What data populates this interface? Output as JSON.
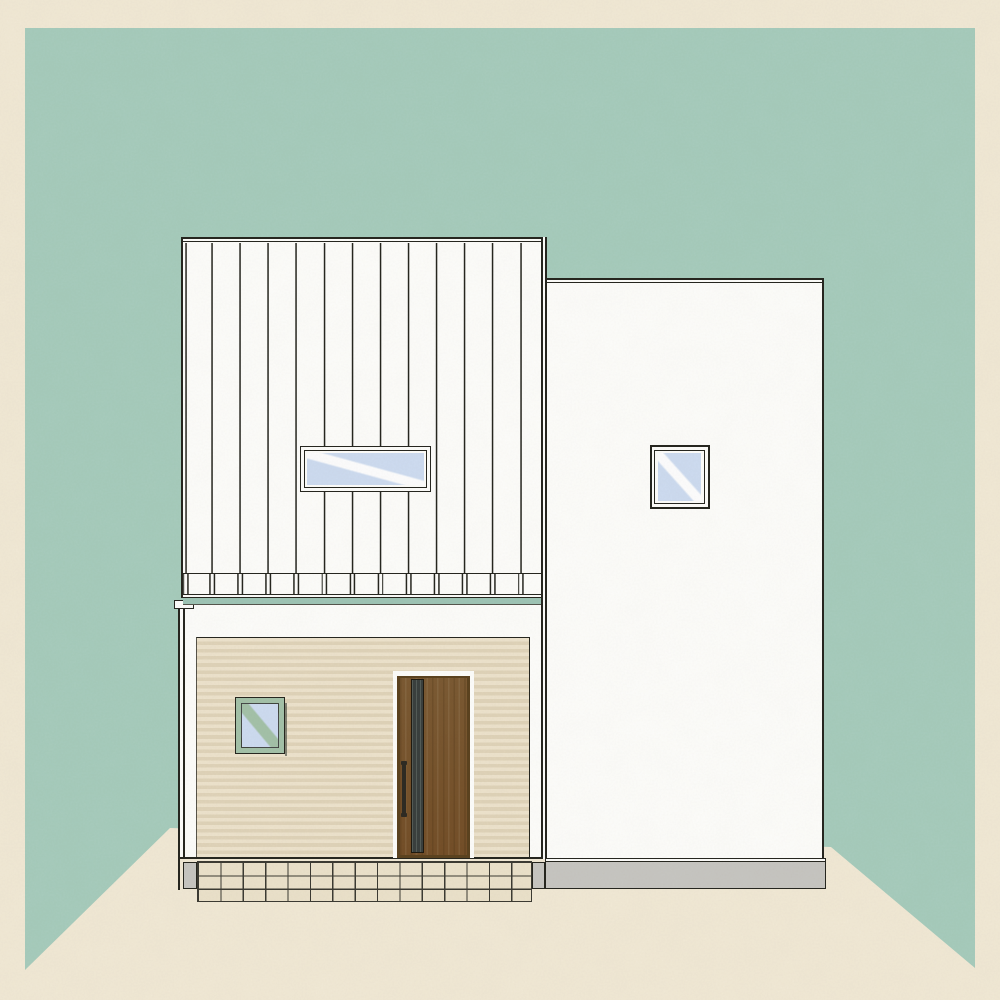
{
  "scene": {
    "type": "architectural-elevation-illustration",
    "subject": "front elevation of a two-story flat-roof house on a teal backdrop with cream paper border",
    "text_content": "none",
    "background": {
      "wall": "teal backdrop wall with 45-degree floor corner diagonals",
      "floor": "cream paper floor",
      "border": "cream paper frame"
    },
    "parts": {
      "upper_left_volume": {
        "cladding": "white vertical board siding with board-end fringe at bottom",
        "window": "wide horizontal window, dark frame, light blue glass with white diagonal reflection"
      },
      "right_volume": {
        "cladding": "plain white wall, dark outline, double parapet line",
        "window": "small square window with double dark frame rings and diagonal reflection",
        "foundation": "gray base band"
      },
      "lower_left_volume": {
        "cladding": "beige horizontally-striped siding panel on white wall",
        "window": "small sage-green framed window with green diagonal reflection",
        "door": "brown wood entry door with narrow dark glass slit and vertical bar handle",
        "flashing": "small white cap at top-left corner",
        "recess_band": "teal shadow gap between floors",
        "base": "cream tile grid apron with gray end blocks"
      }
    },
    "palette": {
      "page_cream": "#f1e9d6",
      "backdrop_teal": "#a7ccbd",
      "band_teal": "#9fc5b6",
      "outline": "#26261f",
      "wall_white": "#fdfdfb",
      "glass_blue": "#cedcf1",
      "sage_frame": "#a4c2a9",
      "beige_light": "#ede3cd",
      "beige_dark": "#e0d4ba",
      "door_brown": "#7b5a33",
      "door_brown_dark": "#5c431f",
      "door_glass": "#3a403e",
      "tile_fill": "#ebe2cb",
      "tile_line": "#3c3b33",
      "base_gray": "#c7c6c2"
    }
  }
}
